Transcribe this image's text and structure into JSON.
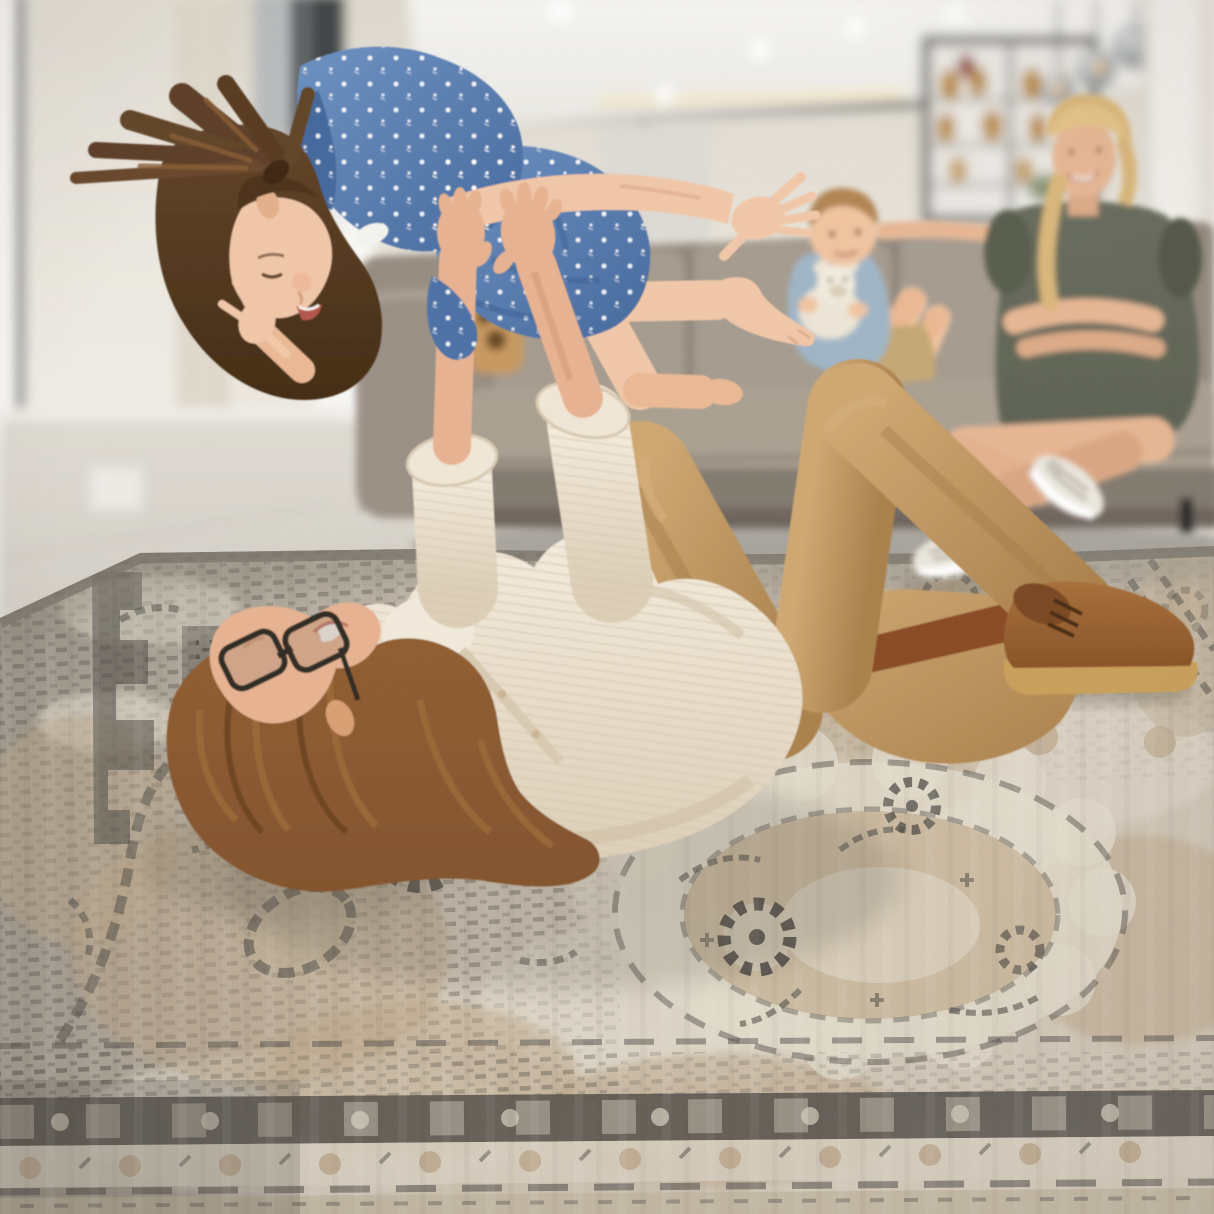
{
  "meta": {
    "type": "photograph",
    "setting": "bright open-plan living room, family playing on a vintage distressed area rug",
    "width_px": 1214,
    "height_px": 1214
  },
  "palette": {
    "wall": "#ece8e0",
    "wall_shadow": "#ddd8cd",
    "ceiling": "#f5f4f1",
    "cove_glow": "#f7e8c9",
    "hall_wall": "#dbd8d3",
    "window_frame": "#42464a",
    "window_glass": "#b9bcbd",
    "curtain": "#e4ded2",
    "stair": "#31353a",
    "door_light": "#f8f7f4",
    "floor": "#d0ccc4",
    "floor_light": "#dfdbd3",
    "baseboard": "#f0ede7",
    "couch": "#978d82",
    "couch_cushion": "#a69c90",
    "couch_base": "#847b71",
    "couch_shadow": "#55504a",
    "couch_leg": "#2e2c29",
    "cabinet_frame": "#6d6c68",
    "cabinet_glass": "#e9e7e2",
    "bottle_amber": "#b8893c",
    "bottle_red": "#8e3a30",
    "plant_green": "#7c8a66",
    "lamp_glass_light": "#d8dadc",
    "lamp_glass_dark": "#75787b",
    "lamp_glow": "#e8a24b",
    "lamp_cord": "#4a4a48",
    "column": "#f3f1ec",
    "mother_hair": "#d9b77c",
    "mother_dress": "#5f6355",
    "skin_mother": "#e6b795",
    "boy_hair": "#b28655",
    "boy_shirt": "#a0b5c6",
    "boy_shorts": "#c5a876",
    "skin_boy": "#f0c4a1",
    "teddy": "#ece5d6",
    "teddy_shade": "#d8ccb6",
    "wood_decor": "#c89a62",
    "father_hair": "#84552f",
    "father_hair_light": "#a5713c",
    "skin_father": "#e7b392",
    "skin_father_shade": "#cf9672",
    "shirt": "#ece2d0",
    "shirt_light": "#f3ebdd",
    "shirt_stripe": "#d7c6ac",
    "glasses": "#332d28",
    "teeth": "#f6f1ea",
    "khaki": "#c1985f",
    "khaki_light": "#cfa873",
    "khaki_shadow": "#a27c49",
    "belt": "#8a4e28",
    "buckle": "#c89a5e",
    "boot": "#a8703c",
    "boot_dark": "#7c4c26",
    "boot_sole": "#c9a05c",
    "girl_hair": "#64462b",
    "girl_hair_dark": "#4f361c",
    "girl_hair_light": "#8a5f38",
    "skin_girl": "#f0c7a9",
    "skin_girl_shade": "#d9a585",
    "dress_blue": "#5b80b4",
    "dress_blue_dark": "#476a9e",
    "dress_dot": "#ffffff",
    "sneaker": "#eae6dd",
    "sneaker_lace": "#b9b4a8",
    "rug_base": "#cfc5b6",
    "rug_dark_zone": "#6e6a62",
    "rug_cream": "#e5decf",
    "rug_beige": "#c2b096",
    "rug_tan": "#b5a284",
    "rug_charcoal": "#4e4b46",
    "rug_border_dark": "#4c4945",
    "rug_border_cream": "#ddd5c5",
    "rug_border_outer": "#c7bba6",
    "rug_edge_binding": "#7b756b",
    "shadow": "#5f584e"
  },
  "scene": {
    "background_objects": [
      "window",
      "sheer-curtain",
      "dark-window-frame",
      "staircase",
      "ceiling-spotlights",
      "cove-light",
      "bar-cabinet-with-bottles",
      "pendant-glass-lamps",
      "white-column",
      "gray-sofa",
      "wood-paw-decor"
    ],
    "foreground_objects": [
      "vintage-distressed-rug",
      "father-lying-on-rug",
      "girl-lifted-airplane",
      "mother-seated-on-sofa",
      "boy-with-teddy-bear"
    ]
  }
}
